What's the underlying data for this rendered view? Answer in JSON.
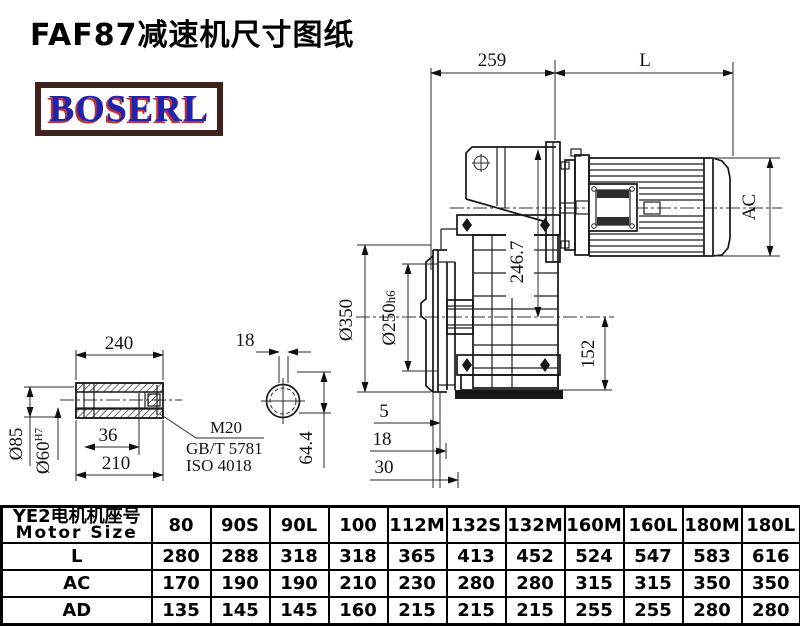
{
  "title": "FAF87减速机尺寸图纸",
  "logo": {
    "text": "BOSERL",
    "border_color": "#40221c",
    "text_color": "#2023ad",
    "shadow_color": "#c62f2f"
  },
  "drawing": {
    "main": {
      "reducer_width": "259",
      "motor_length": "L",
      "motor_diameter": "AC",
      "top_to_center": "246.7",
      "center_to_base": "152",
      "flange_od": "Ø350",
      "pilot_d": "Ø250",
      "pilot_tol": "h6",
      "offset_a": "5",
      "offset_b": "18",
      "offset_c": "30"
    },
    "shaft": {
      "length": "240",
      "od": "Ø85",
      "bore": "Ø60",
      "bore_tol": "H7",
      "step": "36",
      "usable": "210",
      "thread": "M20",
      "std_gb": "GB/T 5781",
      "std_iso": "ISO 4018",
      "key_width": "18",
      "across": "64.4"
    }
  },
  "table": {
    "header_line1": "YE2电机机座号",
    "header_line2": "Motor Size",
    "columns": [
      "80",
      "90S",
      "90L",
      "100",
      "112M",
      "132S",
      "132M",
      "160M",
      "160L",
      "180M",
      "180L"
    ],
    "rows": [
      {
        "label": "L",
        "values": [
          "280",
          "288",
          "318",
          "318",
          "365",
          "413",
          "452",
          "524",
          "547",
          "583",
          "616"
        ]
      },
      {
        "label": "AC",
        "values": [
          "170",
          "190",
          "190",
          "210",
          "230",
          "280",
          "280",
          "315",
          "315",
          "350",
          "350"
        ]
      },
      {
        "label": "AD",
        "values": [
          "135",
          "145",
          "145",
          "160",
          "215",
          "215",
          "215",
          "255",
          "255",
          "280",
          "280"
        ]
      }
    ]
  }
}
